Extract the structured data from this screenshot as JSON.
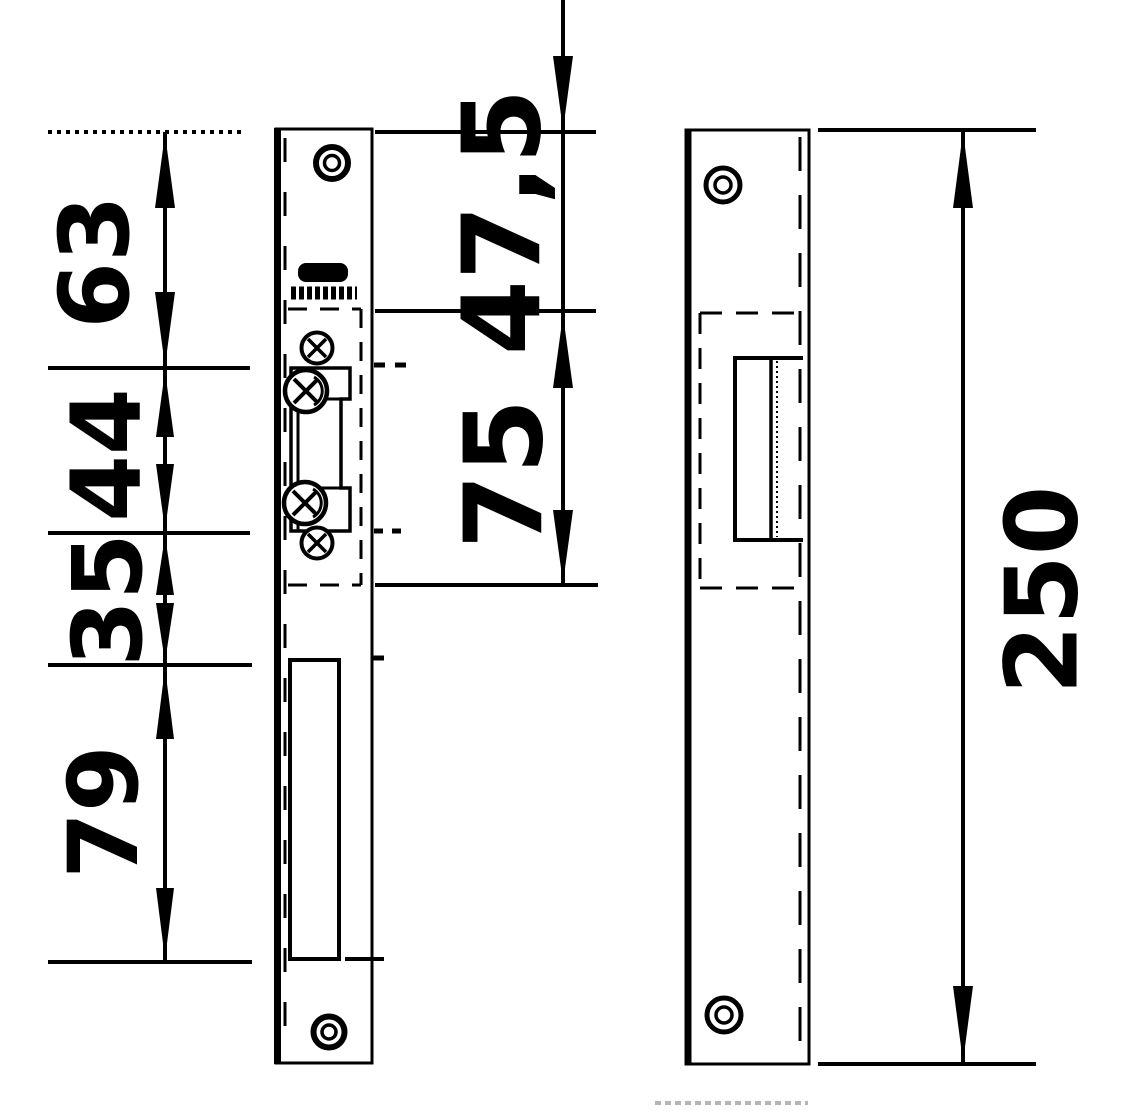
{
  "diagram": {
    "type": "technical-drawing",
    "colors": {
      "background": "#ffffff",
      "ink": "#000000",
      "artifact_gray": "#b5b5b5"
    },
    "dimension_labels": {
      "left_chain": [
        "63",
        "44",
        "35",
        "79"
      ],
      "center_chain": [
        "47,5",
        "75"
      ],
      "overall": "250"
    }
  }
}
